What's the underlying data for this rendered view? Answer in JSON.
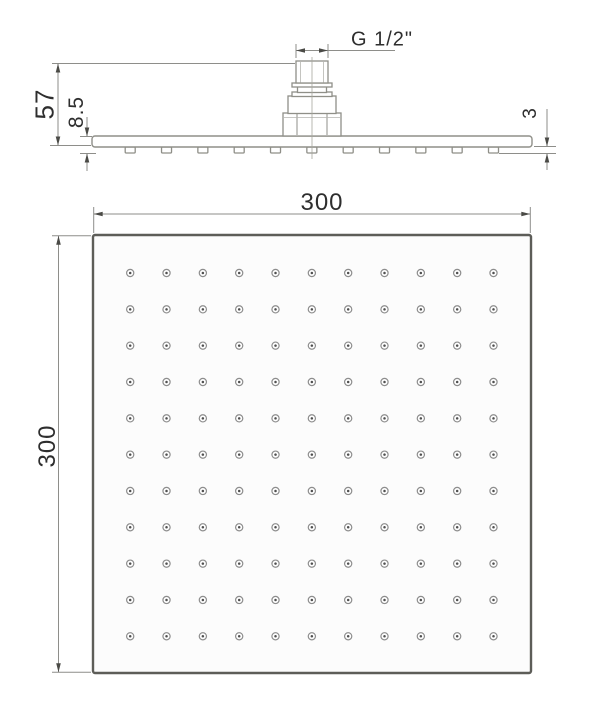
{
  "drawing": {
    "type": "technical-dimension-drawing",
    "side_view": {
      "thread_label": "G 1/2\"",
      "overall_height_label": "57",
      "head_thickness_label": "8.5",
      "nozzle_protrusion_label": "3",
      "nozzle_tab_count": 11
    },
    "face_view": {
      "width_label": "300",
      "height_label": "300",
      "nozzle_grid": {
        "rows": 11,
        "cols": 11,
        "total_nozzles": 121
      }
    },
    "colors": {
      "line": "#8f8f88",
      "dim_line": "#8e8e8a",
      "arrow": "#4a4a46",
      "border": "#5d5d58",
      "text": "#2e2e2e",
      "nozzle_ring": "#8d8d8d",
      "nozzle_center": "#4f4f4f",
      "face_fill": "#fcfcfc",
      "background": "#ffffff"
    }
  }
}
